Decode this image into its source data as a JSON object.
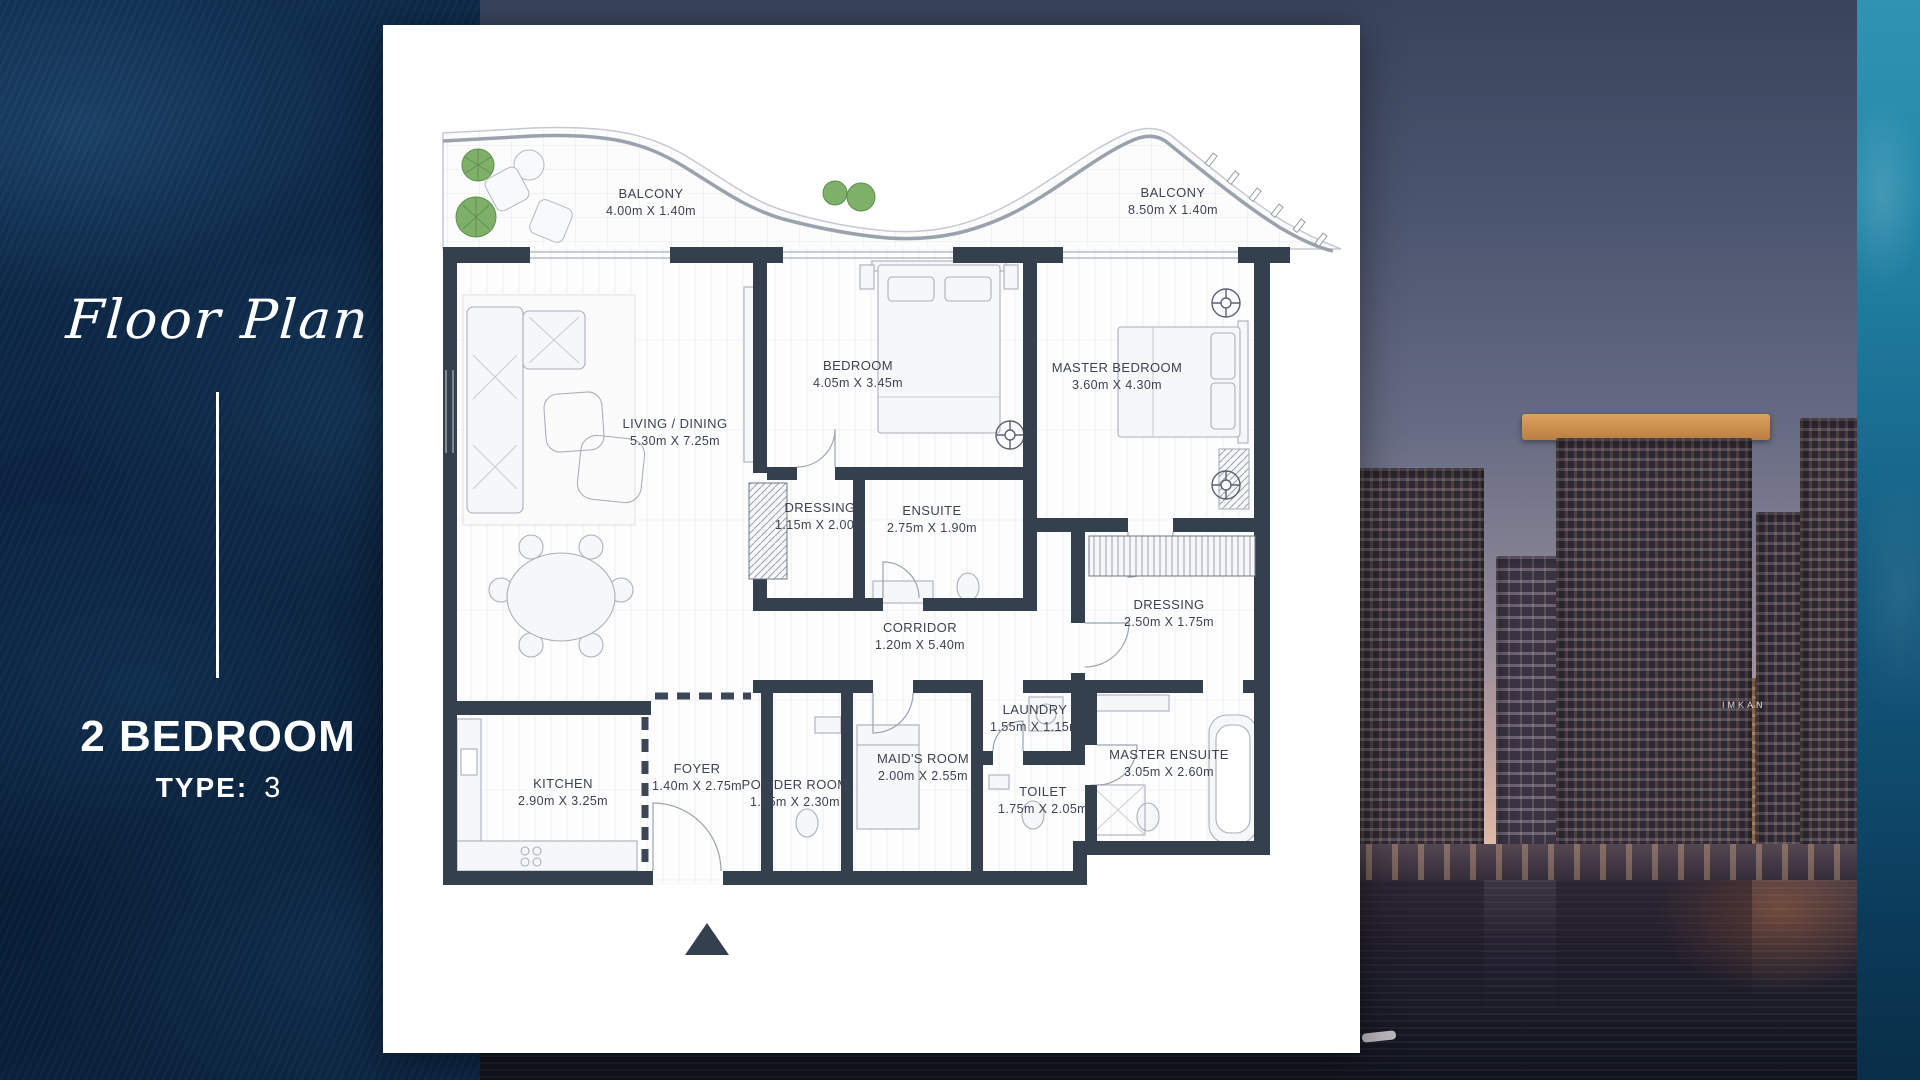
{
  "panel": {
    "script_title": "Floor Plan",
    "unit": "2 BEDROOM",
    "type_label": "TYPE:",
    "type_value": "3"
  },
  "plan": {
    "balconies": [
      {
        "name": "BALCONY",
        "dims": "4.00m X 1.40m"
      },
      {
        "name": "BALCONY",
        "dims": "8.50m X 1.40m"
      }
    ],
    "rooms": [
      {
        "name": "LIVING / DINING",
        "dims": "5.30m X 7.25m"
      },
      {
        "name": "BEDROOM",
        "dims": "4.05m X 3.45m"
      },
      {
        "name": "MASTER BEDROOM",
        "dims": "3.60m X 4.30m"
      },
      {
        "name": "DRESSING",
        "dims": "1.15m X 2.00m"
      },
      {
        "name": "ENSUITE",
        "dims": "2.75m X 1.90m"
      },
      {
        "name": "DRESSING",
        "dims": "2.50m X 1.75m"
      },
      {
        "name": "CORRIDOR",
        "dims": "1.20m X 5.40m"
      },
      {
        "name": "LAUNDRY",
        "dims": "1.55m X 1.15m"
      },
      {
        "name": "MAID'S ROOM",
        "dims": "2.00m X 2.55m"
      },
      {
        "name": "MASTER ENSUITE",
        "dims": "3.05m X 2.60m"
      },
      {
        "name": "KITCHEN",
        "dims": "2.90m X 3.25m"
      },
      {
        "name": "FOYER",
        "dims": "1.40m X 2.75m"
      },
      {
        "name": "POWDER ROOM",
        "dims": "1.65m X 2.30m"
      },
      {
        "name": "TOILET",
        "dims": "1.75m X 2.05m"
      }
    ]
  },
  "photo": {
    "tower_sign": "IMKAN"
  },
  "icons": {
    "entrance_arrow": "▲"
  },
  "colors": {
    "panel_navy": "#0b2442",
    "wall": "#35404f",
    "teal_accent": "#1a6f93",
    "plant_green": "#7fb069",
    "sunset_peach": "#e9c7ae",
    "label_text": "#3b4252"
  }
}
